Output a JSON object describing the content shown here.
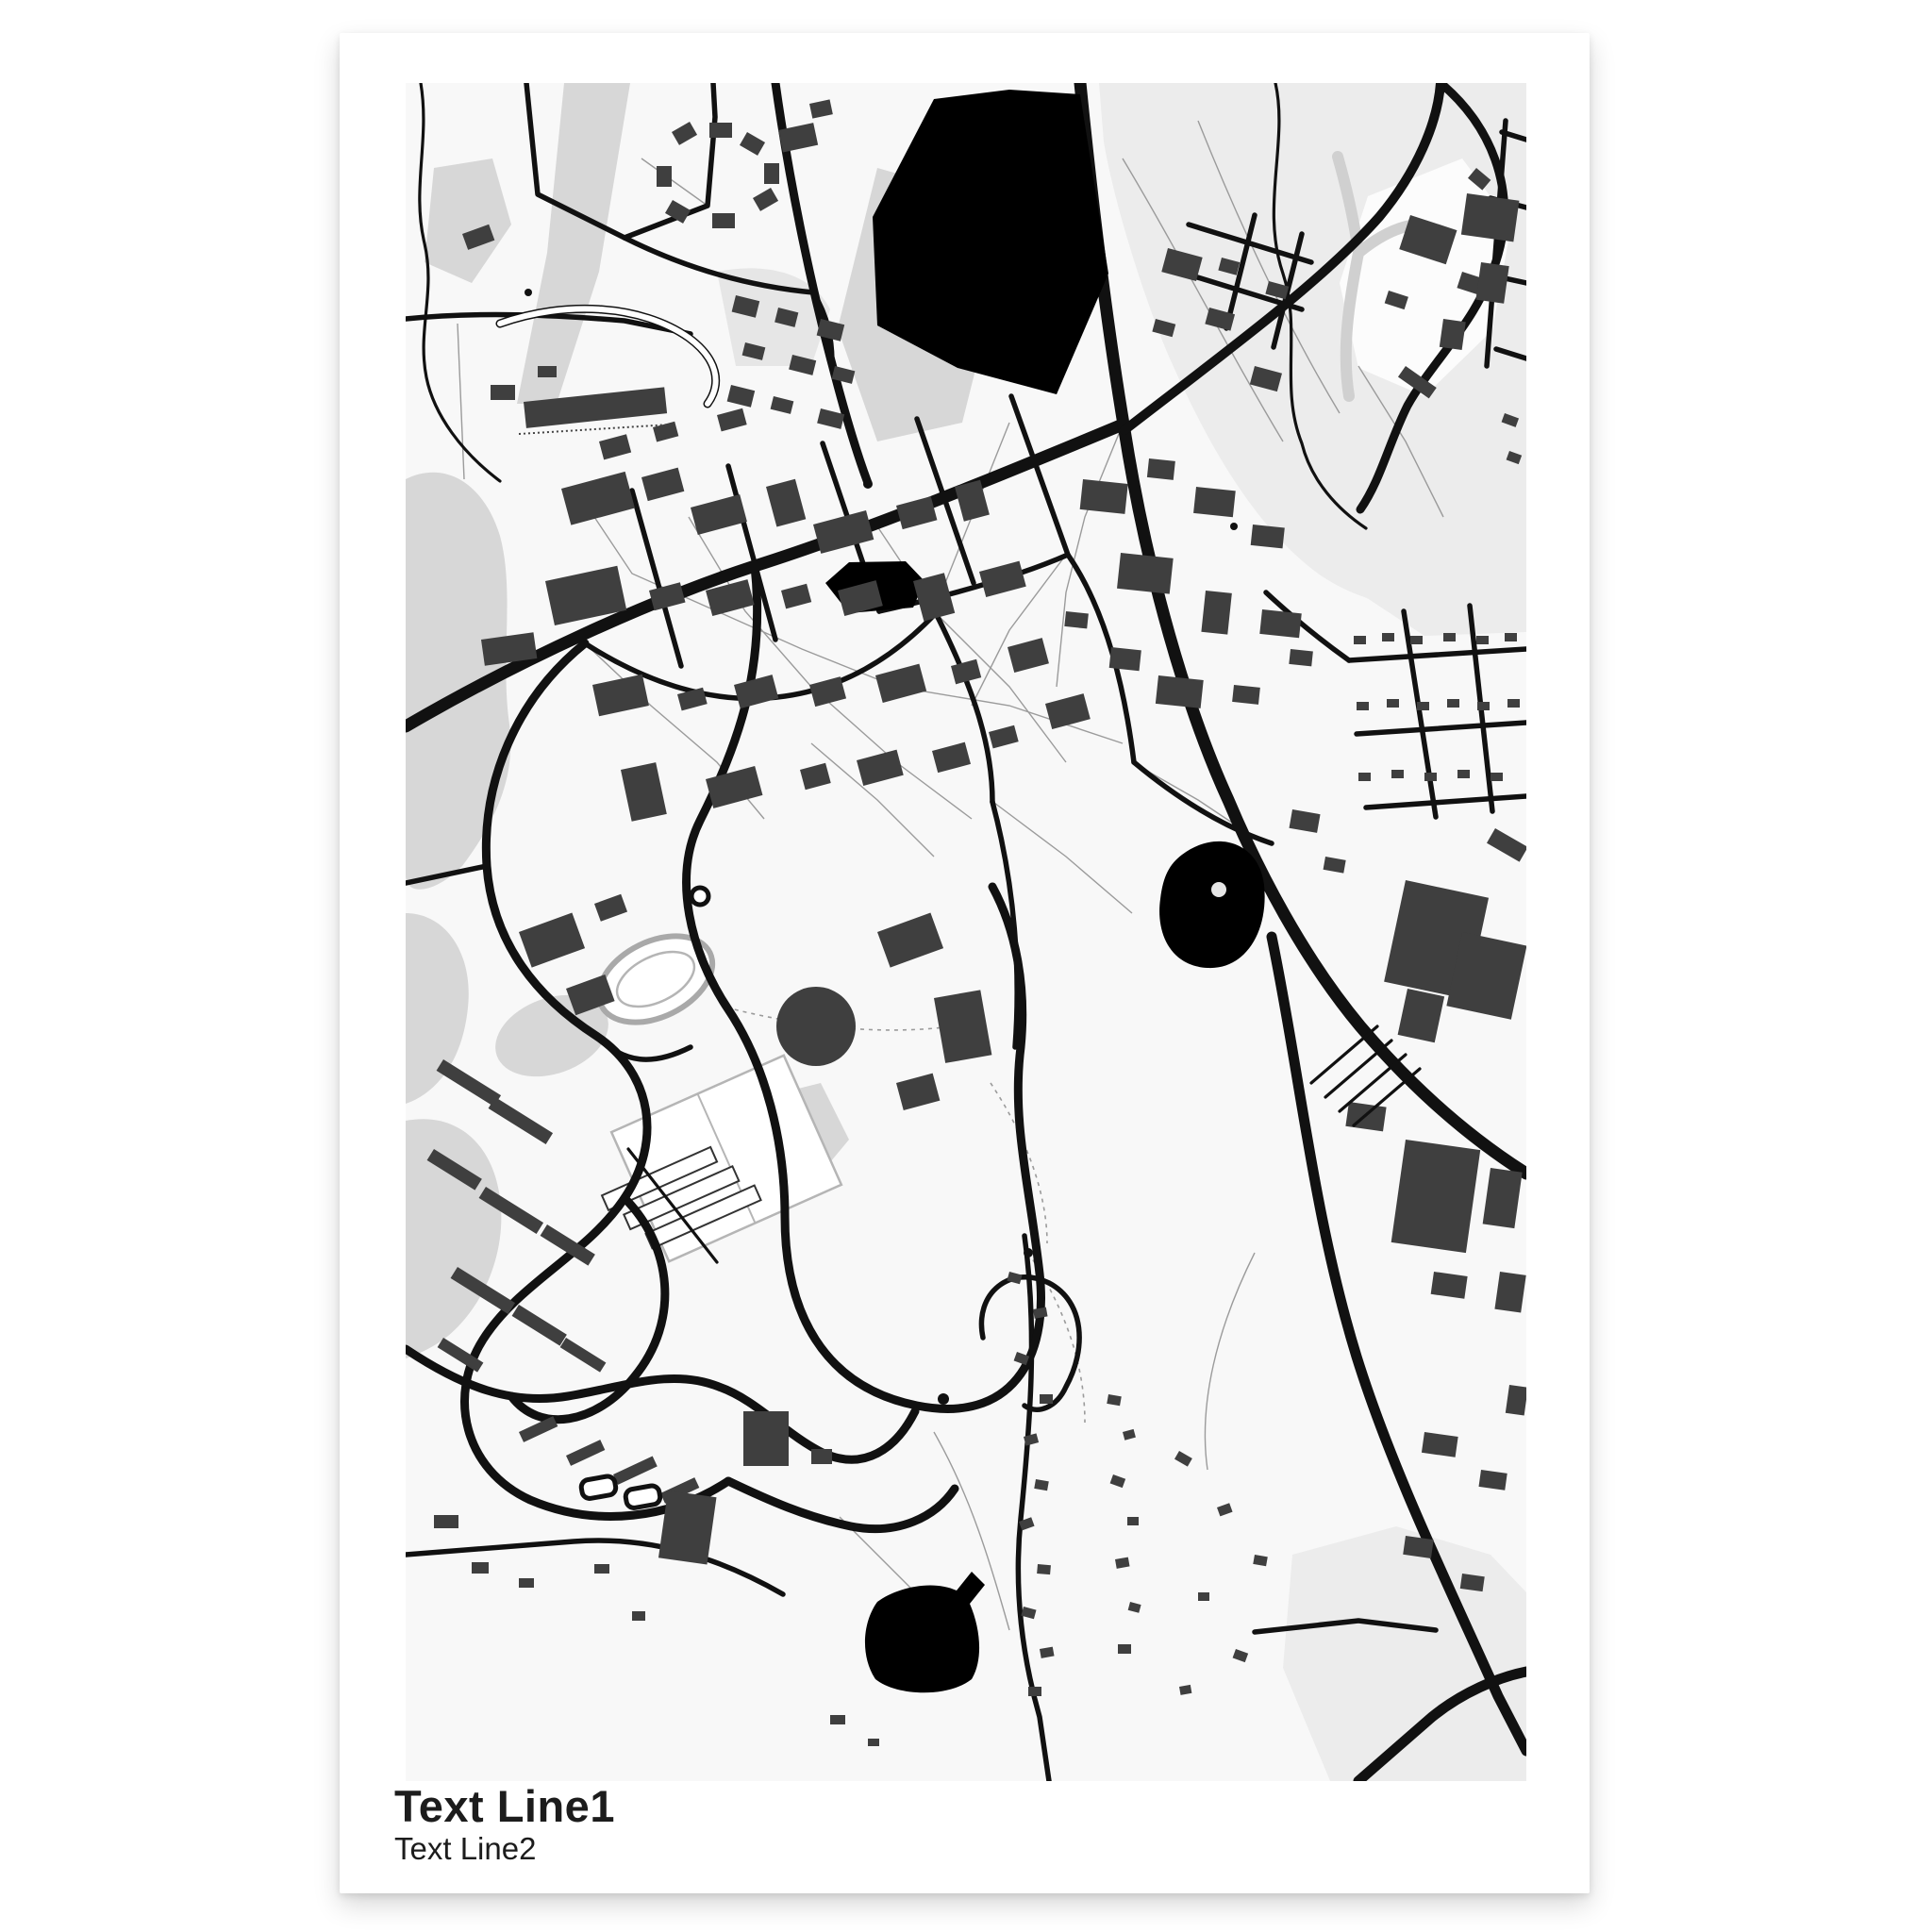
{
  "poster": {
    "title": "Text Line1",
    "subtitle": "Text Line2"
  },
  "colors": {
    "page_bg": "#ffffff",
    "poster_bg": "#ffffff",
    "map_bg": "#f8f8f8",
    "park_light": "#ececec",
    "park_mid": "#d7d7d7",
    "stream_gray": "#d0d0d0",
    "water": "#000000",
    "road": "#111111",
    "building": "#3f3f3f",
    "path_gray": "#9b9b9b",
    "field_outline": "#b5b5b5",
    "text": "#1c1c1c"
  }
}
